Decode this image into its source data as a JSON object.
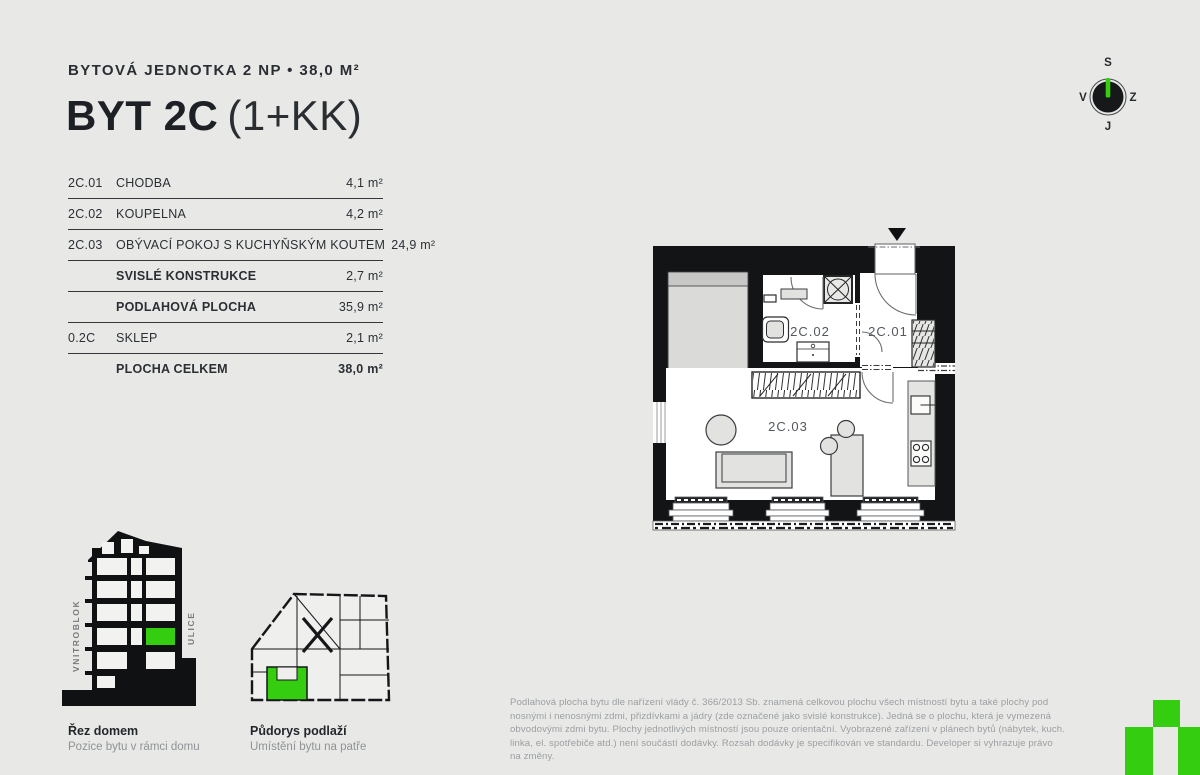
{
  "page": {
    "background_color": "#e8e9e7",
    "accent_green": "#35cd10",
    "wall_color": "#121416"
  },
  "header": {
    "subtitle": "BYTOVÁ JEDNOTKA 2 NP • 38,0 M²",
    "title_main": "BYT 2C",
    "title_suffix": "(1+KK)"
  },
  "area_table": {
    "rows": [
      {
        "code": "2C.01",
        "name": "CHODBA",
        "area": "4,1 m²",
        "bold": false,
        "total": false
      },
      {
        "code": "2C.02",
        "name": "KOUPELNA",
        "area": "4,2 m²",
        "bold": false,
        "total": false
      },
      {
        "code": "2C.03",
        "name": "OBÝVACÍ POKOJ S KUCHYŇSKÝM KOUTEM",
        "area": "24,9 m²",
        "bold": false,
        "total": false
      },
      {
        "code": "",
        "name": "SVISLÉ KONSTRUKCE",
        "area": "2,7 m²",
        "bold": true,
        "total": false
      },
      {
        "code": "",
        "name": "PODLAHOVÁ PLOCHA",
        "area": "35,9 m²",
        "bold": true,
        "total": false
      },
      {
        "code": "0.2C",
        "name": "SKLEP",
        "area": "2,1 m²",
        "bold": false,
        "total": false
      },
      {
        "code": "",
        "name": "PLOCHA CELKEM",
        "area": "38,0 m²",
        "bold": true,
        "total": true
      }
    ]
  },
  "floor_plan": {
    "labels": {
      "hall": "2C.01",
      "bathroom": "2C.02",
      "living": "2C.03"
    }
  },
  "compass": {
    "north": "S",
    "east": "Z",
    "south": "J",
    "west": "V"
  },
  "section_diagram": {
    "left_label": "VNITROBLOK",
    "right_label": "ULICE",
    "caption_title": "Řez domem",
    "caption_sub": "Pozice bytu v rámci domu"
  },
  "floorplate_diagram": {
    "caption_title": "Půdorys podlaží",
    "caption_sub": "Umístění bytu na patře"
  },
  "disclaimer": "Podlahová plocha bytu dle nařízení vlády č. 366/2013 Sb. znamená celkovou plochu všech místností bytu a také plochy pod nosnými i nenosnými zdmi, přizdívkami a jádry (zde označené jako svislé konstrukce). Jedná se o plochu, která je vymezená obvodovými zdmi bytu. Plochy jednotlivých místností jsou pouze orientační. Vyobrazené zařízení v plánech bytů (nábytek, kuch. linka, el. spotřebiče atd.) není součástí dodávky. Rozsah dodávky je specifikován ve standardu. Developer si vyhrazuje právo na změny."
}
